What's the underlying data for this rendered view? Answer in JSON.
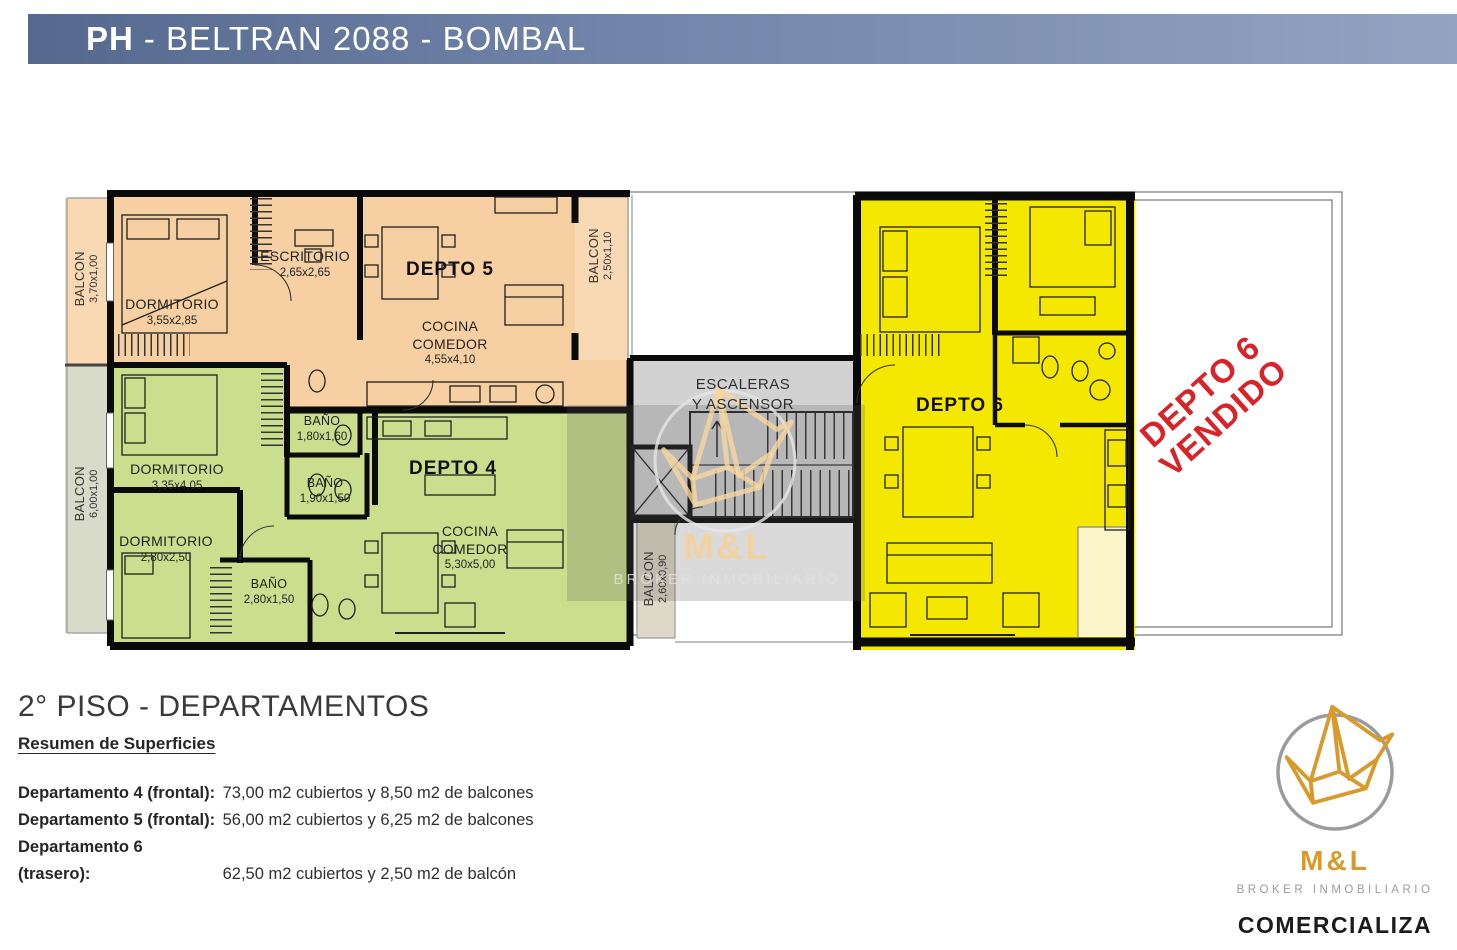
{
  "header": {
    "brand": "PH",
    "rest": "- BELTRAN 2088 - BOMBAL"
  },
  "plan": {
    "balcon_left_top": {
      "label": "BALCON",
      "size": "3,70x1,00"
    },
    "balcon_left_bottom": {
      "label": "BALCON",
      "size": "6,00x1,00"
    },
    "balcon_d5": {
      "label": "BALCON",
      "size": "2,50x1,10"
    },
    "balcon_middle": {
      "label": "BALCON",
      "size": "2,60x0,90"
    },
    "d5": {
      "title": "DEPTO 5",
      "dormitorio": {
        "label": "DORMITORIO",
        "size": "3,55x2,85"
      },
      "escritorio": {
        "label": "ESCRITORIO",
        "size": "2,65x2,65"
      },
      "cocina": {
        "l1": "COCINA",
        "l2": "COMEDOR",
        "size": "4,55x4,10"
      },
      "bano": {
        "label": "BAÑO",
        "size": "1,80x1,60"
      }
    },
    "d4": {
      "title": "DEPTO 4",
      "dormitorio1": {
        "label": "DORMITORIO",
        "size": "3,35x4,05"
      },
      "dormitorio2": {
        "label": "DORMITORIO",
        "size": "2,80x2,50"
      },
      "bano1": {
        "label": "BAÑO",
        "size": "1,90x1,50"
      },
      "bano2": {
        "label": "BAÑO",
        "size": "2,80x1,50"
      },
      "cocina": {
        "l1": "COCINA",
        "l2": "COMEDOR",
        "size": "5,30x5,00"
      }
    },
    "d6": {
      "title": "DEPTO 6"
    },
    "escaleras": {
      "l1": "ESCALERAS",
      "l2": "Y ASCENSOR"
    },
    "sold": {
      "l1": "DEPTO 6",
      "l2": "VENDIDO"
    },
    "watermark": {
      "name": "M&L",
      "subtitle": "BROKER INMOBILIARIO"
    }
  },
  "summary": {
    "title": "2° PISO - DEPARTAMENTOS",
    "subtitle": "Resumen de Superficies",
    "rows": [
      {
        "label": "Departamento 4 (frontal):",
        "value": "73,00 m2 cubiertos y 8,50 m2 de balcones"
      },
      {
        "label": "Departamento 5 (frontal):",
        "value": "56,00 m2 cubiertos y 6,25 m2 de balcones"
      },
      {
        "label": "Departamento 6 (trasero):",
        "value": "62,50 m2 cubiertos y 2,50 m2 de balcón"
      }
    ]
  },
  "logo": {
    "name": "M&L",
    "subtitle": "BROKER INMOBILIARIO",
    "tagline": "COMERCIALIZA"
  },
  "colors": {
    "header_left": "#55688d",
    "header_right": "#93a3c2",
    "depto4_green": "#cade8e",
    "depto5_peach": "#f6d0a2",
    "depto6_yellow": "#f5e800",
    "balcony_peach": "#f8d9b4",
    "balcony_gray": "#d9dbca",
    "stairs_gray": "#d2d2d2",
    "sold_red": "#da2328",
    "gold": "#d89a2c"
  }
}
